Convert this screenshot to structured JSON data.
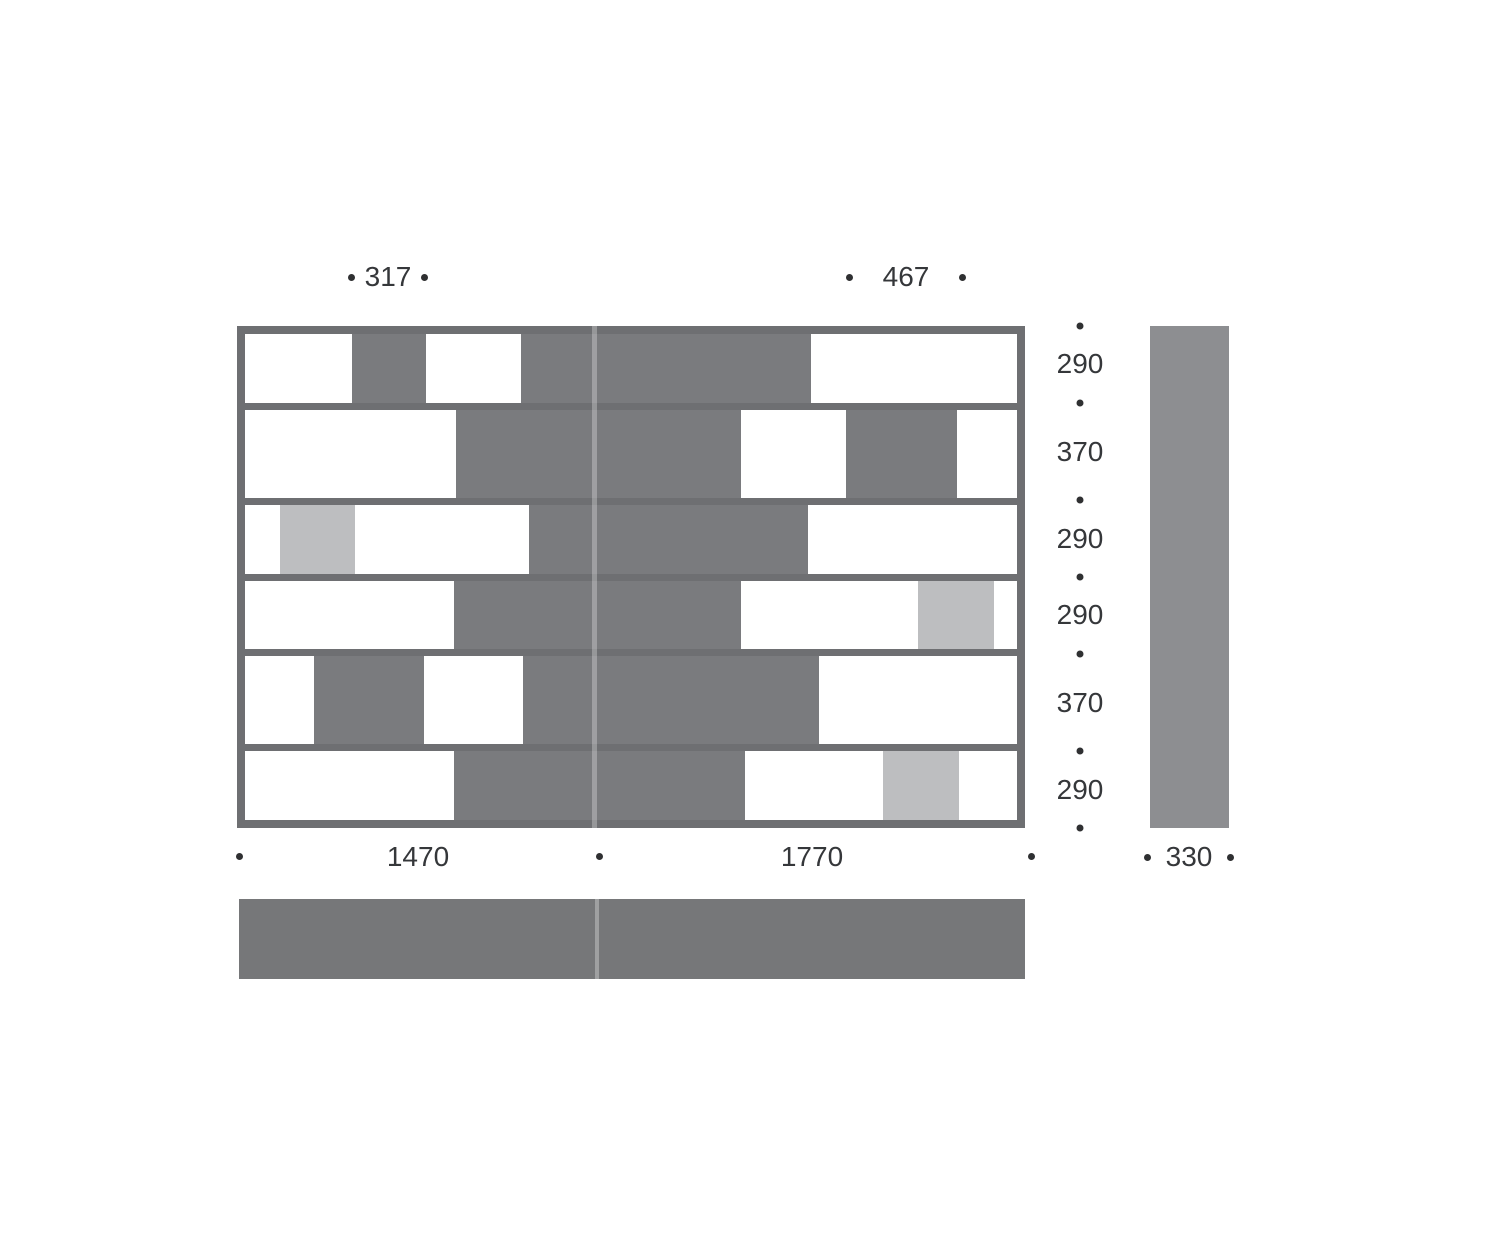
{
  "drawing": {
    "kind": "shelving-unit dimension drawing",
    "views": [
      "front",
      "side",
      "top"
    ]
  },
  "colors": {
    "frame": "#6e6f72",
    "cell_dark": "#7a7b7e",
    "cell_light": "#bdbec0",
    "cell_white": "#ffffff",
    "side_bar": "#8d8e91",
    "top_bar": "#767779",
    "dot": "#2f3032",
    "text": "#35373a"
  },
  "front_view": {
    "rows": [
      {
        "height_mm": 290,
        "segments": [
          {
            "type": "white",
            "w": 107
          },
          {
            "type": "dark",
            "w": 75
          },
          {
            "type": "white",
            "w": 95
          },
          {
            "type": "dark",
            "w": 291
          },
          {
            "type": "white",
            "w": 207
          }
        ]
      },
      {
        "height_mm": 370,
        "segments": [
          {
            "type": "white",
            "w": 212
          },
          {
            "type": "dark",
            "w": 286
          },
          {
            "type": "white",
            "w": 105
          },
          {
            "type": "dark",
            "w": 112
          },
          {
            "type": "white",
            "w": 60
          }
        ]
      },
      {
        "height_mm": 290,
        "segments": [
          {
            "type": "white",
            "w": 35
          },
          {
            "type": "light",
            "w": 75
          },
          {
            "type": "white",
            "w": 175
          },
          {
            "type": "dark",
            "w": 280
          },
          {
            "type": "white",
            "w": 210
          }
        ]
      },
      {
        "height_mm": 290,
        "segments": [
          {
            "type": "white",
            "w": 210
          },
          {
            "type": "dark",
            "w": 288
          },
          {
            "type": "white",
            "w": 178
          },
          {
            "type": "light",
            "w": 76
          },
          {
            "type": "white",
            "w": 23
          }
        ]
      },
      {
        "height_mm": 370,
        "segments": [
          {
            "type": "white",
            "w": 69
          },
          {
            "type": "dark",
            "w": 111
          },
          {
            "type": "white",
            "w": 99
          },
          {
            "type": "dark",
            "w": 297
          },
          {
            "type": "white",
            "w": 199
          }
        ]
      },
      {
        "height_mm": 290,
        "segments": [
          {
            "type": "white",
            "w": 210
          },
          {
            "type": "dark",
            "w": 292
          },
          {
            "type": "white",
            "w": 138
          },
          {
            "type": "light",
            "w": 77
          },
          {
            "type": "white",
            "w": 58
          }
        ]
      }
    ]
  },
  "dimensions": {
    "top_left": "317",
    "top_right": "467",
    "right_rows": [
      "290",
      "370",
      "290",
      "290",
      "370",
      "290"
    ],
    "bottom_left": "1470",
    "bottom_right": "1770",
    "depth": "330"
  }
}
